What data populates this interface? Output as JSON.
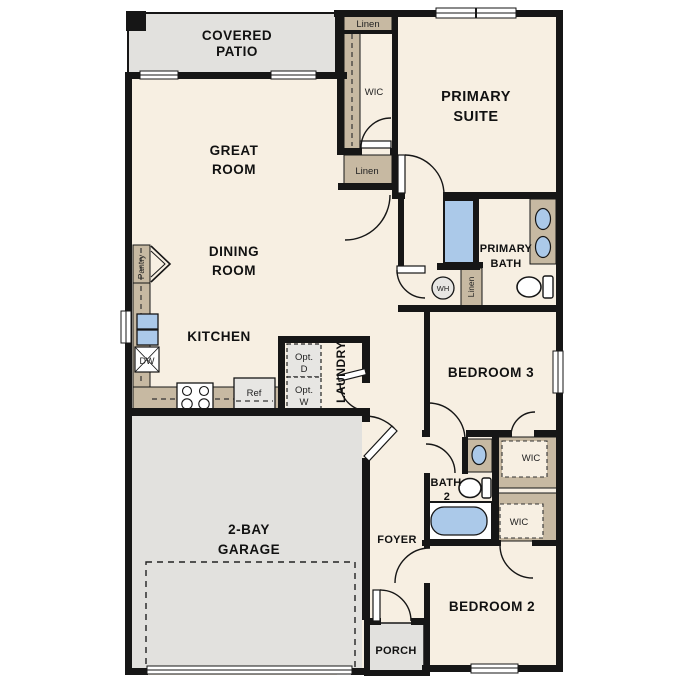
{
  "plan": {
    "rooms": {
      "covered_patio": {
        "line1": "COVERED",
        "line2": "PATIO"
      },
      "great_room": {
        "line1": "GREAT",
        "line2": "ROOM"
      },
      "dining_room": {
        "line1": "DINING",
        "line2": "ROOM"
      },
      "kitchen": {
        "label": "KITCHEN"
      },
      "primary_suite": {
        "line1": "PRIMARY",
        "line2": "SUITE"
      },
      "primary_bath": {
        "line1": "PRIMARY",
        "line2": "BATH"
      },
      "bedroom3": {
        "label": "BEDROOM 3"
      },
      "bedroom2": {
        "label": "BEDROOM 2"
      },
      "bath2": {
        "line1": "BATH",
        "line2": "2"
      },
      "garage": {
        "line1": "2-BAY",
        "line2": "GARAGE"
      },
      "foyer": {
        "label": "FOYER"
      },
      "porch": {
        "label": "PORCH"
      },
      "laundry": {
        "label": "LAUNDRY"
      }
    },
    "closets": {
      "linen_top": "Linen",
      "wic_top": "WIC",
      "linen_mid": "Linen",
      "linen_hall": "Linen",
      "pantry": "Pantry",
      "wic_bedroom3": "WIC",
      "wic_bedroom2": "WIC"
    },
    "fixtures": {
      "water_heater": "WH",
      "dishwasher": "DW",
      "refrigerator": "Ref",
      "opt_dryer_line1": "Opt.",
      "opt_dryer_line2": "D",
      "opt_washer_line1": "Opt.",
      "opt_washer_line2": "W"
    },
    "colors": {
      "floor": "#f7efe2",
      "patio_garage": "#e2e1de",
      "cabinet_tan": "#c7b9a2",
      "fixture_blue": "#abc9e9",
      "appliance_gray": "#e7e6e3",
      "wall": "#161616"
    }
  }
}
